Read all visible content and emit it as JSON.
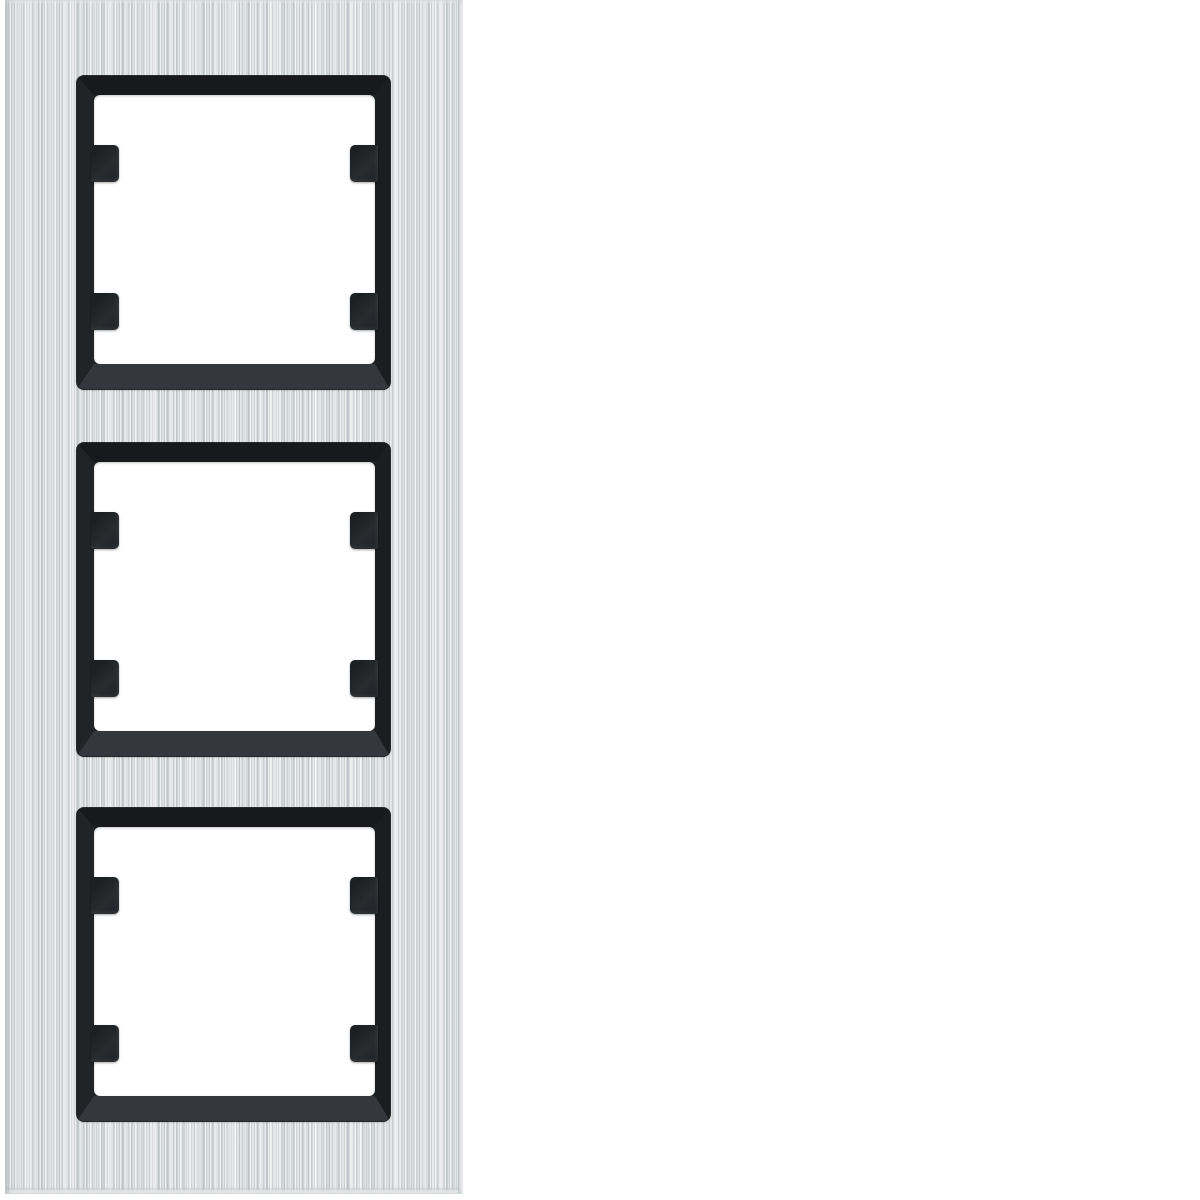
{
  "scene": {
    "description": "Product photograph of a 3-gang vertical cover frame for flush-mounted light switches, brushed aluminium finish with black inner frames",
    "text_visible": "",
    "background": "plain white"
  },
  "product": {
    "kind": "switch-cover-frame",
    "orientation": "vertical",
    "gang_count": 3,
    "finish": "brushed-aluminium",
    "inner_frame_finish": "matte-black",
    "clips_per_opening": 4
  },
  "colors": {
    "background_white": "#ffffff",
    "plate_base": "#dadde0",
    "plate_streak_light": "#f2f4f5",
    "plate_streak_dark": "#c0c5c8",
    "frame_black": "#212427",
    "frame_bevel_dark": "#17191c",
    "frame_bevel_light": "#34383c",
    "opening_white": "#ffffff",
    "clip_black": "#282c2f"
  },
  "openings": [
    {
      "id": "top",
      "label": "opening 1 of 3"
    },
    {
      "id": "middle",
      "label": "opening 2 of 3"
    },
    {
      "id": "bottom",
      "label": "opening 3 of 3"
    }
  ]
}
